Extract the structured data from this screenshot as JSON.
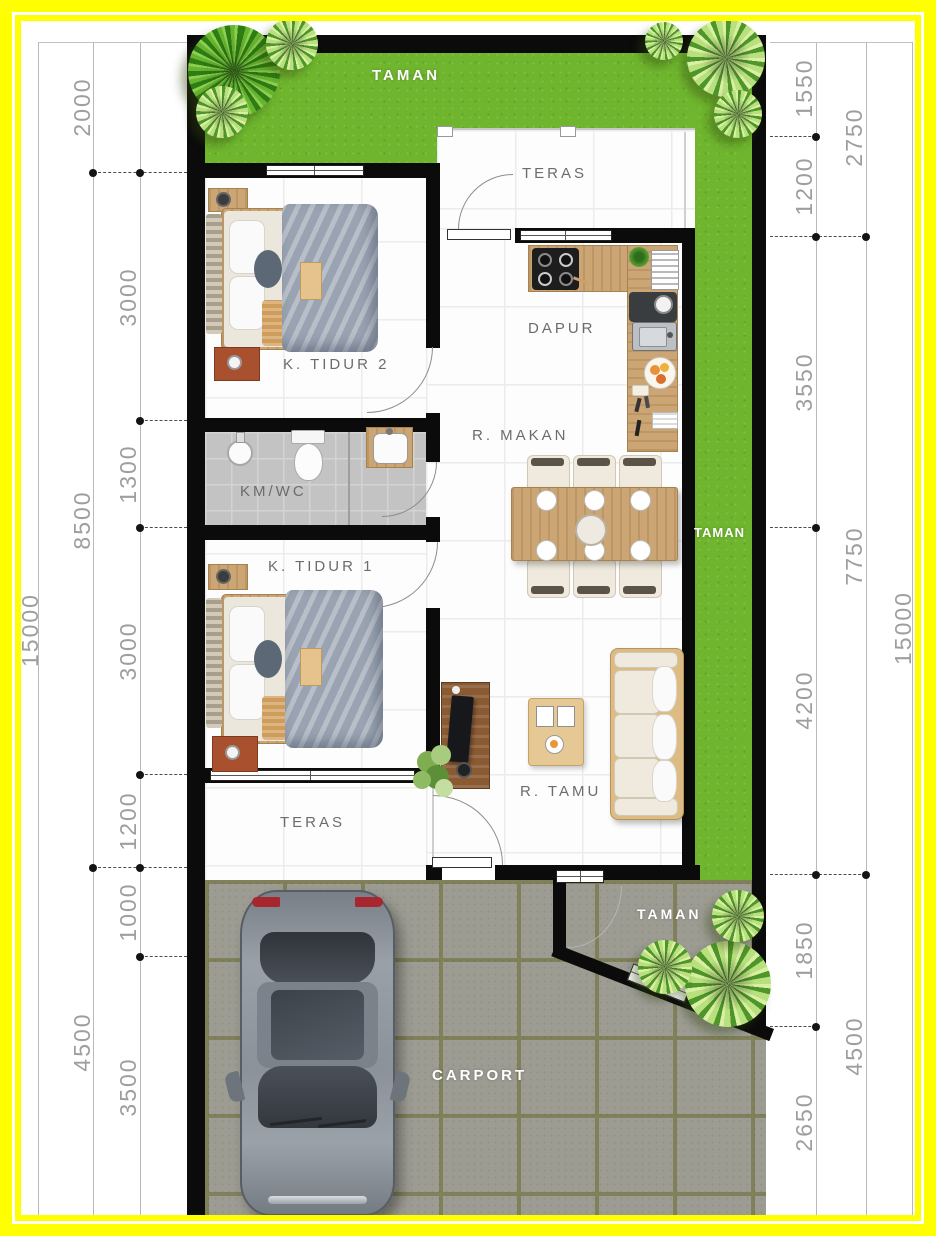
{
  "labels": {
    "taman_top": "TAMAN",
    "teras_top": "TERAS",
    "dapur": "DAPUR",
    "k_tidur_2": "K. TIDUR 2",
    "km_wc": "KM/WC",
    "r_makan": "R. MAKAN",
    "taman_right": "TAMAN",
    "k_tidur_1": "K. TIDUR 1",
    "r_tamu": "R. TAMU",
    "teras_bottom": "TERAS",
    "taman_bottom": "TAMAN",
    "carport": "CARPORT"
  },
  "dimensions": {
    "left_outer": [
      "15000"
    ],
    "left_mid": [
      "2000",
      "8500",
      "4500"
    ],
    "left_inner": [
      "3000",
      "1300",
      "3000",
      "1200",
      "1000",
      "3500"
    ],
    "right_inner": [
      "1550",
      "1200",
      "3550",
      "4200",
      "1850",
      "2650"
    ],
    "right_mid": [
      "2750",
      "7750",
      "4500"
    ],
    "right_outer": [
      "15000"
    ]
  },
  "colors": {
    "frame_yellow": "#ffff00",
    "grass_green": "#6fb62e",
    "wall_black": "#0b0b0b",
    "paving_gray": "#9c9c93",
    "wood_tan": "#cba573",
    "dimension_text": "#9e9e9e"
  }
}
